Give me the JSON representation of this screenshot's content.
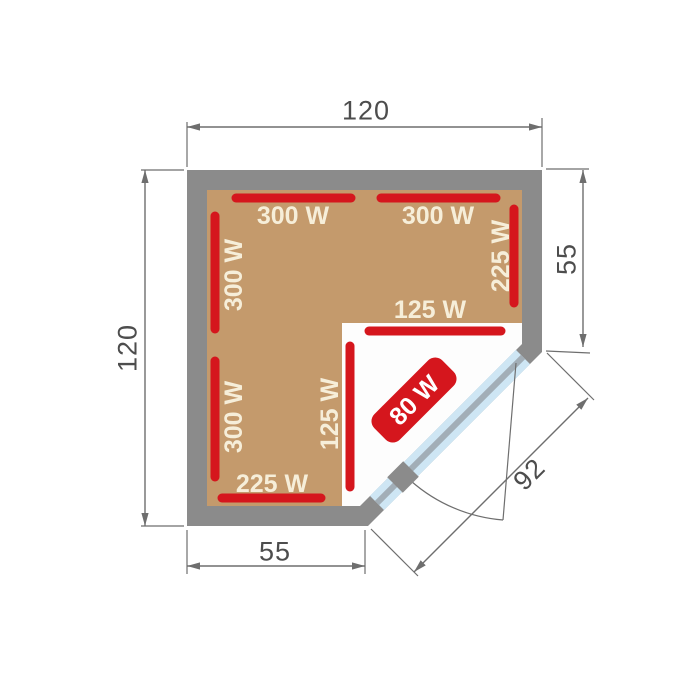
{
  "diagram": {
    "name": "Corner sauna floor plan with infrared heater wattages",
    "dimensions": {
      "top_width": "120",
      "left_height": "120",
      "right_upper_wall": "55",
      "bottom_left_wall": "55",
      "door_diagonal": "92"
    },
    "heaters": {
      "top_left": "300 W",
      "top_right": "300 W",
      "right_wall": "225 W",
      "left_wall_upper": "300 W",
      "left_wall_lower": "300 W",
      "notch_top": "125 W",
      "notch_side": "125 W",
      "bottom_wall": "225 W",
      "door_side": "80 W"
    },
    "colors": {
      "wall": "#8B8B8B",
      "floor": "#C49A6C",
      "heater": "#D5161D",
      "heater_label": "#F6EED9",
      "door_glass": "#CEE6F4",
      "door_frame": "#A2AEB7",
      "dimension": "#6E6E6E"
    }
  }
}
